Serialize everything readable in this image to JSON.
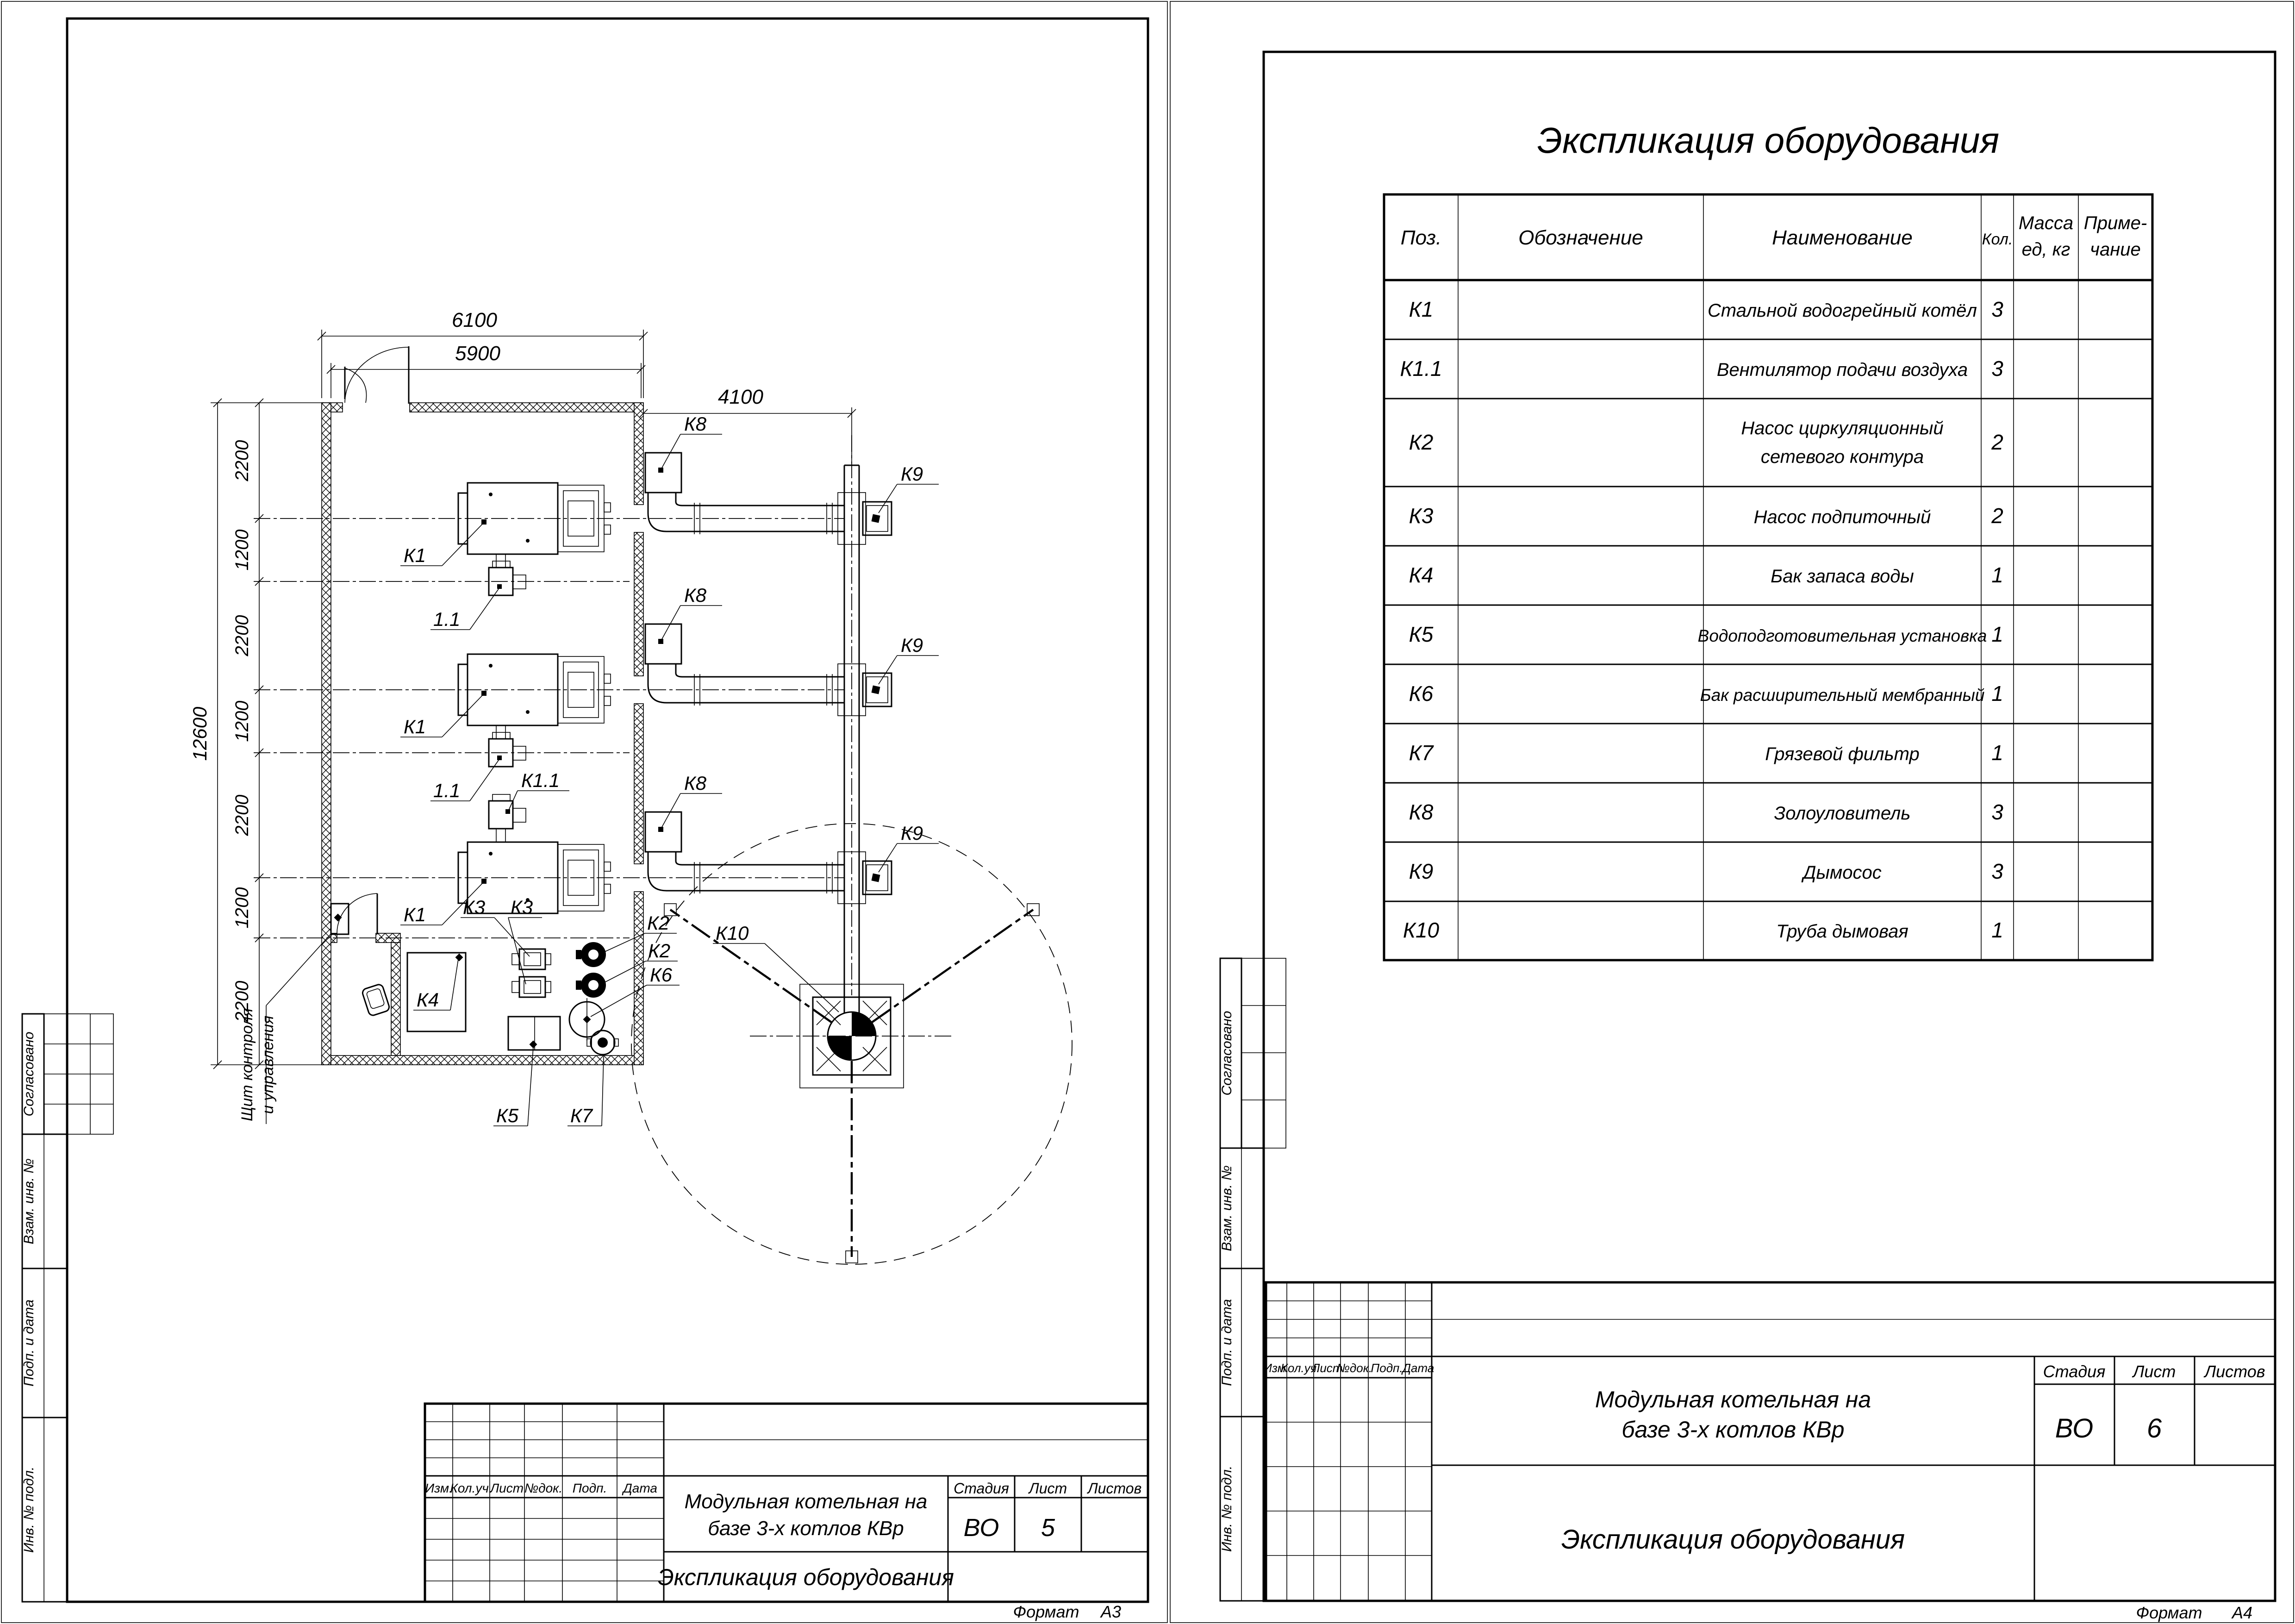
{
  "common": {
    "doc_name": "Экспликация оборудования",
    "project_line1": "Модульная котельная на",
    "project_line2": "базе 3-х котлов КВр",
    "stage_label": "Стадия",
    "sheet_label": "Лист",
    "sheets_label": "Листов",
    "stage_value": "ВО",
    "format_label": "Формат",
    "revision_header": {
      "izm": "Изм.",
      "koluch": "Кол.уч.",
      "list": "Лист",
      "ndok": "№док.",
      "podp": "Подп.",
      "data": "Дата"
    },
    "side_stamp": {
      "agreed": "Согласовано",
      "replace_inv": "Взам. инв. №",
      "sign_date": "Подп. и дата",
      "inv_orig": "Инв. № подл."
    }
  },
  "left_sheet": {
    "sheet_number": "5",
    "sheets_value": "",
    "format_value": "А3",
    "dims": {
      "d6100": "6100",
      "d5900": "5900",
      "d4100": "4100",
      "d12600": "12600",
      "chain": [
        "2200",
        "1200",
        "2200",
        "1200",
        "2200",
        "1200",
        "2200"
      ]
    },
    "labels": {
      "k1": "К1",
      "k1_1": "1.1",
      "k11": "К1.1",
      "k2": "К2",
      "k3": "К3",
      "k4": "К4",
      "k5": "К5",
      "k6": "К6",
      "k7": "К7",
      "k8": "К8",
      "k9": "К9",
      "k10": "К10",
      "panel_line1": "Щит контроля",
      "panel_line2": "и управления"
    }
  },
  "right_sheet": {
    "sheet_number": "6",
    "sheets_value": "",
    "format_value": "А4",
    "table_title": "Экспликация оборудования",
    "table": {
      "header": {
        "pos": "Поз.",
        "designation": "Обозначение",
        "name": "Наименование",
        "qty": "Кол.",
        "mass_line1": "Масса",
        "mass_line2": "ед, кг",
        "note_line1": "Приме-",
        "note_line2": "чание"
      },
      "rows": [
        {
          "pos": "К1",
          "name": "Стальной водогрейный котёл",
          "name2": "",
          "qty": "3"
        },
        {
          "pos": "К1.1",
          "name": "Вентилятор подачи воздуха",
          "name2": "",
          "qty": "3"
        },
        {
          "pos": "К2",
          "name": "Насос циркуляционный",
          "name2": "сетевого контура",
          "qty": "2"
        },
        {
          "pos": "К3",
          "name": "Насос подпиточный",
          "name2": "",
          "qty": "2"
        },
        {
          "pos": "К4",
          "name": "Бак запаса воды",
          "name2": "",
          "qty": "1"
        },
        {
          "pos": "К5",
          "name": "Водоподготовительная установка",
          "name2": "",
          "qty": "1"
        },
        {
          "pos": "К6",
          "name": "Бак расширительный мембранный",
          "name2": "",
          "qty": "1"
        },
        {
          "pos": "К7",
          "name": "Грязевой фильтр",
          "name2": "",
          "qty": "1"
        },
        {
          "pos": "К8",
          "name": "Золоуловитель",
          "name2": "",
          "qty": "3"
        },
        {
          "pos": "К9",
          "name": "Дымосос",
          "name2": "",
          "qty": "3"
        },
        {
          "pos": "К10",
          "name": "Труба дымовая",
          "name2": "",
          "qty": "1"
        }
      ]
    }
  }
}
